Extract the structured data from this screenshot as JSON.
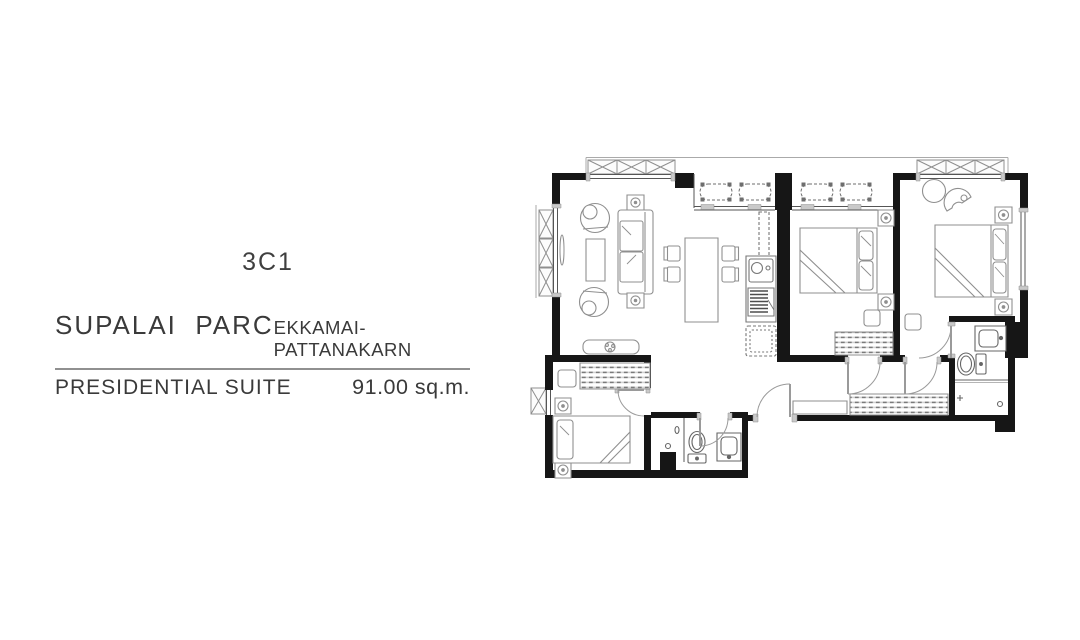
{
  "page": {
    "background": "#ffffff"
  },
  "plan_card": {
    "unit_type": "3C1",
    "project_name": "SUPALAI  PARC",
    "project_location": "EKKAMAI-PATTANAKARN",
    "unit_name": "PRESIDENTIAL SUITE",
    "unit_area": "91.00 sq.m."
  },
  "colors": {
    "wall": "#161616",
    "furniture_line": "#8f8f8f",
    "fixture_line": "#666666",
    "sill_gray": "#c9c9c9",
    "divider_rule": "#909090",
    "text": "#3a3a3a"
  },
  "floorplan_icons": [
    "ac-condenser-unit-icon",
    "sofa-icon",
    "armchair-icon",
    "coffee-table-icon",
    "dining-table-icon",
    "dining-chair-icon",
    "tv-console-icon",
    "plant-icon",
    "kitchen-sink-icon",
    "stove-icon",
    "refrigerator-icon",
    "double-bed-icon",
    "single-bed-icon",
    "nightstand-lamp-icon",
    "wardrobe-icon",
    "walk-in-closet-icon",
    "toilet-icon",
    "vanity-sink-icon",
    "shower-icon",
    "door-swing-icon",
    "window-icon",
    "round-table-icon",
    "lounge-chair-icon",
    "stool-icon"
  ]
}
